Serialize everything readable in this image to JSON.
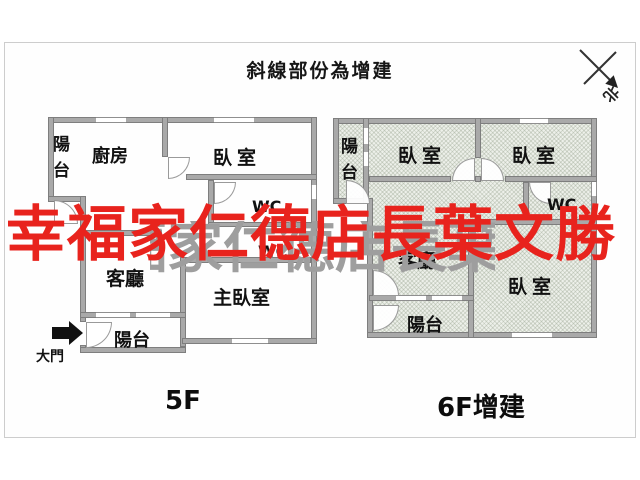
{
  "title": "斜線部份為增建",
  "compass": {
    "north_label": "北"
  },
  "watermark": {
    "text": "幸福家仁德店長葉文勝",
    "shadow_text": "幸福家仁德店長葉文勝",
    "color": "#e8231d",
    "shadow_color": "#9e9e9e"
  },
  "colors": {
    "wall": "#a9a9a9",
    "hatch_base": "#edf0ea",
    "frame_border": "#cdcdcd",
    "label_text": "#111111"
  },
  "plans": {
    "f5": {
      "name_label": "5F",
      "rooms": {
        "balcony_top": "陽台",
        "kitchen": "廚房",
        "bedroom": "臥室",
        "wc_upper": "WC",
        "wc_lower": "WC",
        "living": "客廳",
        "master_bedroom": "主臥室",
        "balcony_bottom": "陽台",
        "main_door": "大門"
      }
    },
    "f6": {
      "name_label": "6F增建",
      "rooms": {
        "balcony_top": "陽台",
        "bedroom_left": "臥室",
        "bedroom_right": "臥室",
        "wc": "WC",
        "living": "客廳",
        "bedroom_bottom": "臥室",
        "balcony_bottom": "陽台"
      }
    }
  }
}
